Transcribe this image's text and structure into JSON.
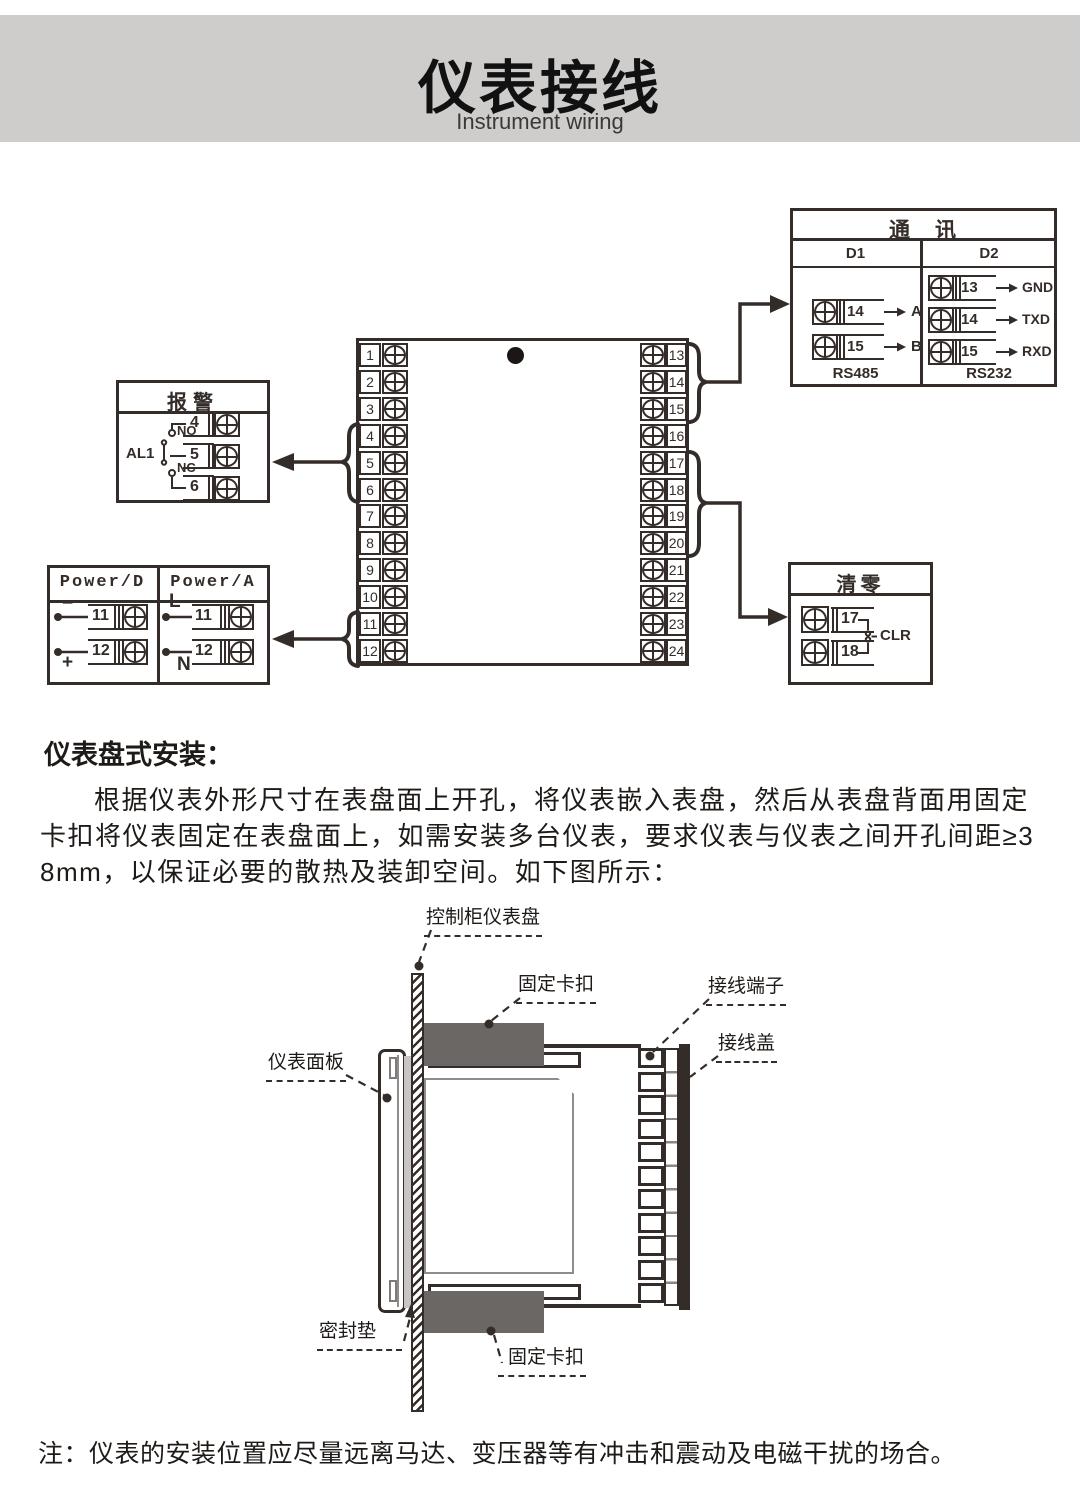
{
  "page": {
    "title": "仪表接线",
    "subtitle": "Instrument wiring"
  },
  "colors": {
    "line": "#342c28",
    "band": "#cfcdcc",
    "clip_gray": "#6b6764",
    "gasket_gray": "#c8c5c2"
  },
  "wiring": {
    "main_block": {
      "left_terminals": [
        "1",
        "2",
        "3",
        "4",
        "5",
        "6",
        "7",
        "8",
        "9",
        "10",
        "11",
        "12"
      ],
      "right_terminals": [
        "13",
        "14",
        "15",
        "16",
        "17",
        "18",
        "19",
        "20",
        "21",
        "22",
        "23",
        "24"
      ]
    },
    "alarm_box": {
      "title": "报警",
      "relay_label": "AL1",
      "no_label": "NO",
      "nc_label": "NC",
      "terminals": [
        "4",
        "5",
        "6"
      ]
    },
    "power_box": {
      "columns": [
        {
          "title": "Power/D",
          "rows": [
            {
              "polarity": "−",
              "terminal": "11"
            },
            {
              "polarity": "+",
              "terminal": "12"
            }
          ]
        },
        {
          "title": "Power/A",
          "rows": [
            {
              "polarity": "L",
              "terminal": "11"
            },
            {
              "polarity": "N",
              "terminal": "12"
            }
          ]
        }
      ]
    },
    "comm_box": {
      "title": "通　讯",
      "columns": [
        {
          "header": "D1",
          "standard": "RS485",
          "rows": [
            {
              "terminal": "14",
              "signal": "A"
            },
            {
              "terminal": "15",
              "signal": "B"
            }
          ]
        },
        {
          "header": "D2",
          "standard": "RS232",
          "rows": [
            {
              "terminal": "13",
              "signal": "GND"
            },
            {
              "terminal": "14",
              "signal": "TXD"
            },
            {
              "terminal": "15",
              "signal": "RXD"
            }
          ]
        }
      ]
    },
    "clear_box": {
      "title": "清零",
      "terminals": [
        "17",
        "18"
      ],
      "signal": "CLR"
    }
  },
  "install": {
    "heading": "仪表盘式安装：",
    "paragraph": "根据仪表外形尺寸在表盘面上开孔，将仪表嵌入表盘，然后从表盘背面用固定卡扣将仪表固定在表盘面上，如需安装多台仪表，要求仪表与仪表之间开孔间距≥38mm，以保证必要的散热及装卸空间。如下图所示：",
    "labels": {
      "panel": "控制柜仪表盘",
      "clip_top": "固定卡扣",
      "terminal": "接线端子",
      "cover": "接线盖",
      "front_panel": "仪表面板",
      "gasket": "密封垫",
      "clip_bottom": "固定卡扣"
    }
  },
  "note": "注：仪表的安装位置应尽量远离马达、变压器等有冲击和震动及电磁干扰的场合。"
}
